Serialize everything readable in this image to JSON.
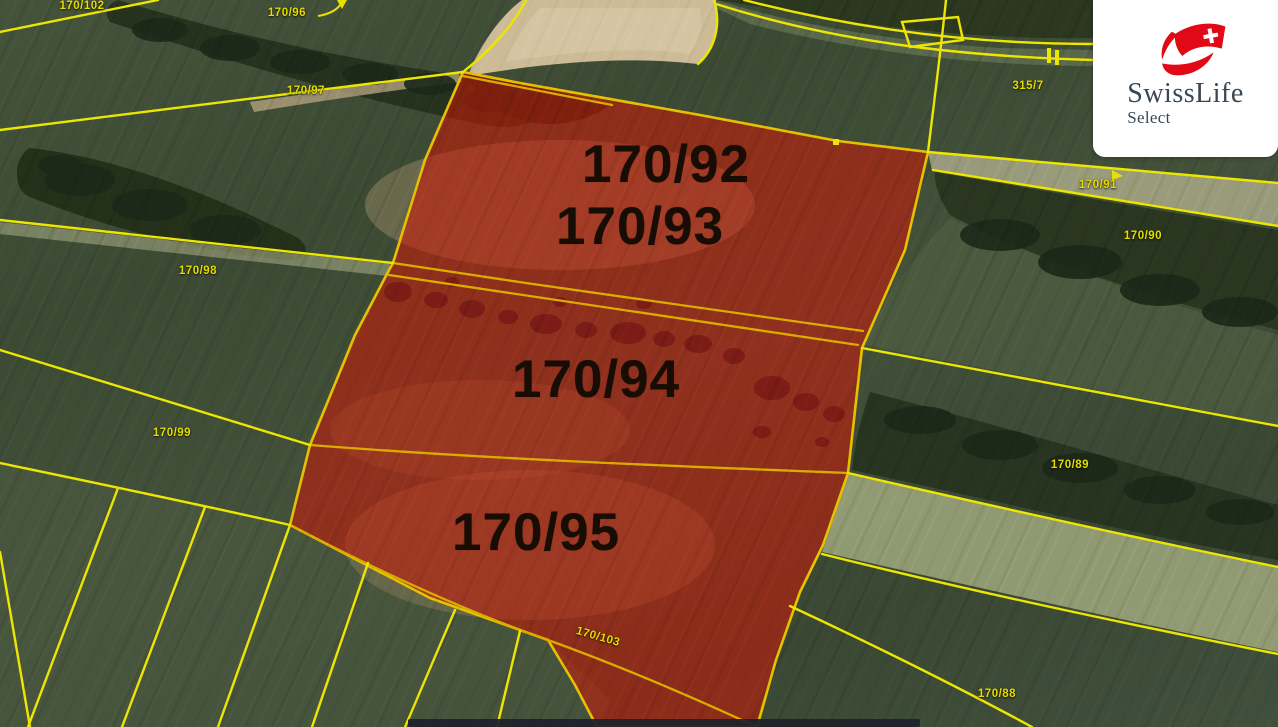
{
  "map": {
    "highlighted_parcels": [
      {
        "label": "170/92"
      },
      {
        "label": "170/93"
      },
      {
        "label": "170/94"
      },
      {
        "label": "170/95"
      }
    ],
    "parcel_labels": [
      {
        "label": "170/102"
      },
      {
        "label": "170/96"
      },
      {
        "label": "170/97"
      },
      {
        "label": "170/98"
      },
      {
        "label": "170/99"
      },
      {
        "label": "315/7"
      },
      {
        "label": "170/91"
      },
      {
        "label": "170/90"
      },
      {
        "label": "170/89"
      },
      {
        "label": "170/88"
      },
      {
        "label": "170/103"
      }
    ],
    "colors": {
      "parcel_line_yellow": "#ece600",
      "inner_line_orange": "#dcab00",
      "highlight_red": "#d01606",
      "highlight_border": "#e6c100",
      "parcel_number_black": "#170d05",
      "small_label_yellow": "#e6dd00"
    }
  },
  "watermark": {
    "brand": "SwissLife",
    "product": "Select",
    "logo_red": "#e20917",
    "text_color": "#3a4652"
  }
}
